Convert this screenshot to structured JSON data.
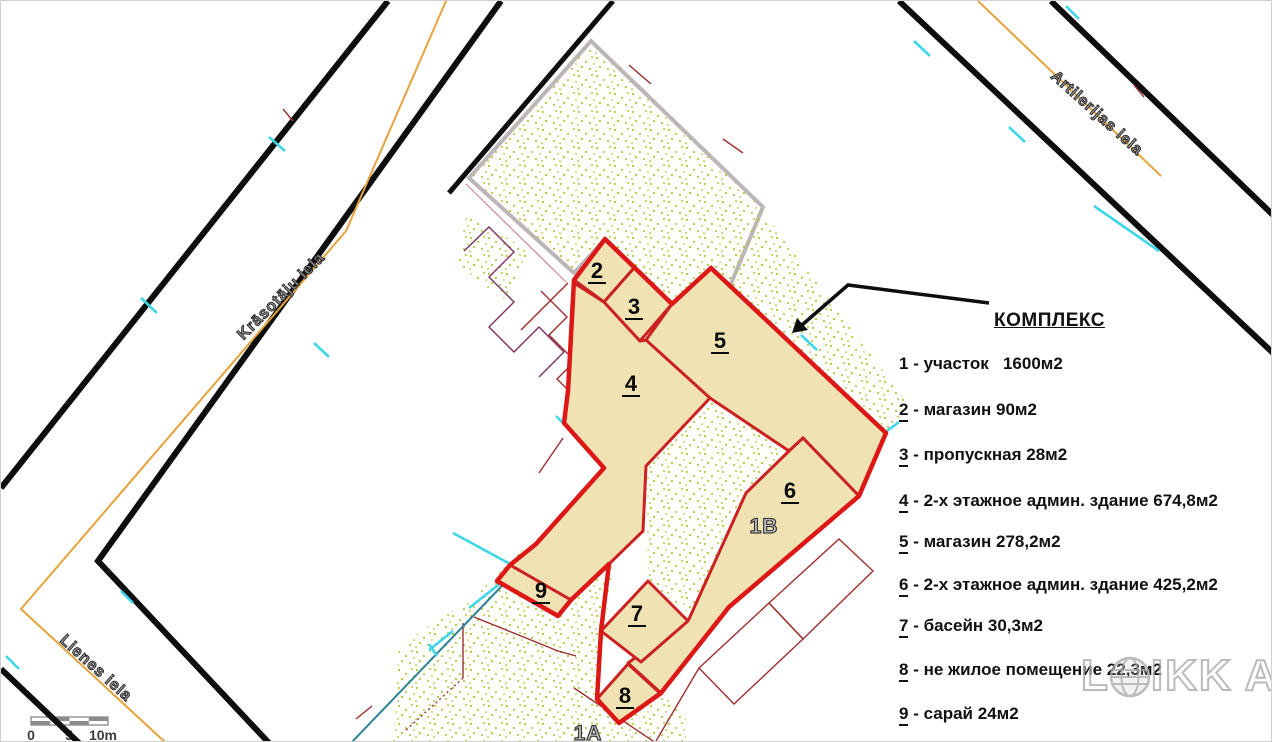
{
  "plan": {
    "numbers": [
      "2",
      "3",
      "4",
      "5",
      "6",
      "7",
      "8",
      "9"
    ],
    "unit_labels": [
      "1B",
      "1A"
    ]
  },
  "streets": {
    "left": "Krāsotāju iela",
    "right": "Artilerijas iela",
    "bottom": "Lienes iela"
  },
  "legend": {
    "title": "КОМПЛЕКС",
    "separator": " - ",
    "items": [
      {
        "num": "1",
        "text": "участок   1600м2",
        "underline": false
      },
      {
        "num": "2",
        "text": "магазин 90м2",
        "underline": true
      },
      {
        "num": "3",
        "text": "пропускная 28м2",
        "underline": true
      },
      {
        "num": "4",
        "text": "2-х этажное админ. здание 674,8м2",
        "underline": true
      },
      {
        "num": "5",
        "text": "магазин 278,2м2",
        "underline": true
      },
      {
        "num": "6",
        "text": "2-х этажное админ. здание 425,2м2",
        "underline": true
      },
      {
        "num": "7",
        "text": "басейн 30,3м2",
        "underline": true
      },
      {
        "num": "8",
        "text": "не жилое помещение 22,3м2",
        "underline": true
      },
      {
        "num": "9",
        "text": "сарай 24м2",
        "underline": true
      }
    ]
  },
  "scale_bar": {
    "start": "0",
    "middle": "5",
    "end": "10m"
  },
  "watermark": {
    "prefix": "L",
    "suffix": "IKK",
    "trailing": "A"
  },
  "colors": {
    "plot_boundary_red": "#dd1616",
    "building_fill": "#f0e2b2",
    "building_stroke": "#cc2121",
    "vegetation_green": "#b5c832",
    "street_black": "#0d0d0d",
    "street_centerline_orange": "#e4a33b",
    "neighbor_parcel_grey": "#bdb6b6",
    "survey_cyan": "#3fd6e8",
    "utility_teal": "#2e8196",
    "cadastral_line_maroon": "#9c2f2f",
    "cadastral_line_purple": "#7c3060"
  }
}
